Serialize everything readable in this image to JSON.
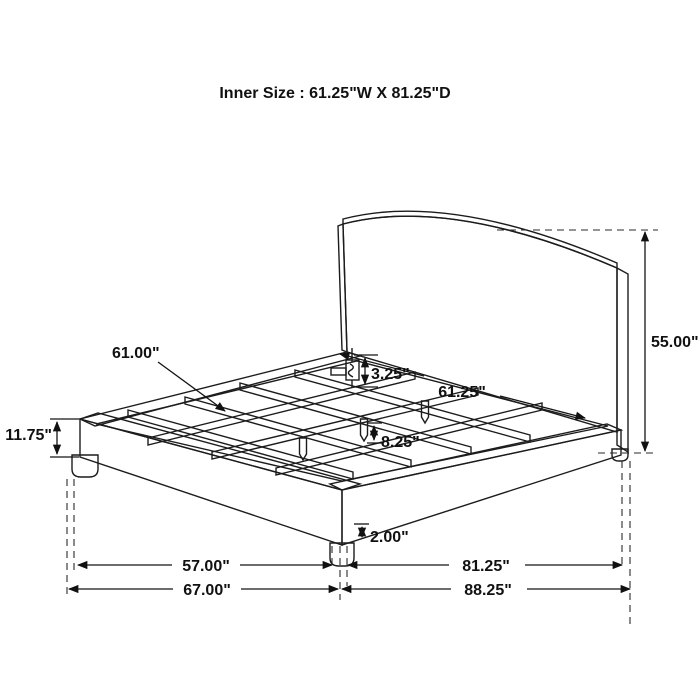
{
  "title": "Inner Size : 61.25\"W X 81.25\"D",
  "diagram": {
    "subject": "upholstered-platform-bed-dimension-drawing",
    "line_color": "#1c1c1c",
    "background_color": "#ffffff",
    "texture": "herringbone-weave"
  },
  "dimensions": {
    "slat_length": "61.00\"",
    "bracket_height": "3.25\"",
    "inner_width": "61.25\"",
    "overall_height": "55.00\"",
    "side_rail_height": "11.75\"",
    "under_clearance": "8.25\"",
    "leg_height": "2.00\"",
    "width_between_legs": "57.00\"",
    "overall_width": "67.00\"",
    "depth_between_legs": "81.25\"",
    "overall_depth": "88.25\""
  }
}
